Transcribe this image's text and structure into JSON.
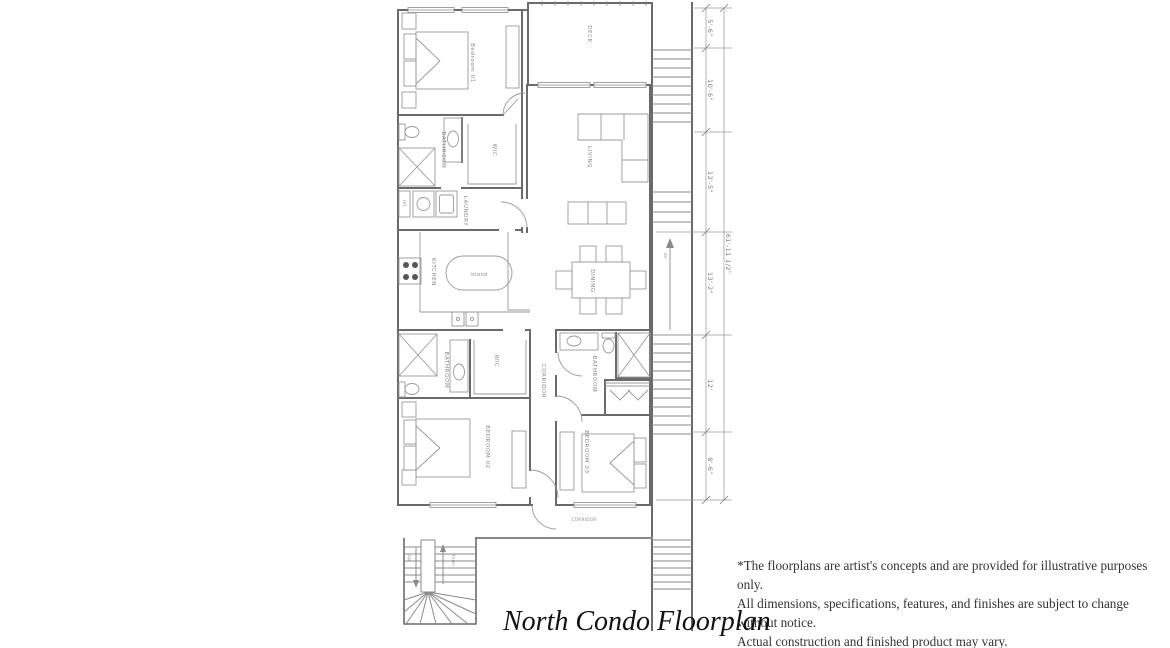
{
  "title": "North Condo Floorplan",
  "disclaimer": {
    "line1": "*The floorplans are artist's concepts and are provided for illustrative purposes only.",
    "line2": "All dimensions, specifications, features, and finishes are subject to change without notice.",
    "line3": "Actual construction and finished product may vary."
  },
  "rooms": {
    "bedroom01": "Bedroom 01",
    "deck": "DECK",
    "bathroom_top": "BATHROOM",
    "wic_top": "WIC",
    "laundry": "LAUNDRY",
    "ref": "ref",
    "kitchen": "KITCHEN",
    "island": "island",
    "living": "LIVING",
    "dining": "DINING",
    "corridor_v": "CORRIDOR",
    "bathroom_btm": "BATHROOM",
    "wic_btm": "WIC",
    "bathroom_right": "BATHROOM",
    "bedroom02": "BEDROOM 02",
    "bedroom03": "BEDROOM 03",
    "corridor_h": "CORRIDOR"
  },
  "stairs": {
    "up": "up",
    "down": "down",
    "dn": "dn"
  },
  "dimensions": {
    "segments": [
      "5'-6\"",
      "10'-6\"",
      "12'-5\"",
      "13'-2\"",
      "12'",
      "8'-6\""
    ],
    "total": "61'-11 1/2\""
  },
  "colors": {
    "wall_line": "#6a6a6a",
    "furniture_line": "#999999",
    "label_text": "#8a8a8a",
    "title_text": "#111111",
    "disclaimer_text": "#333333",
    "background": "#ffffff"
  }
}
